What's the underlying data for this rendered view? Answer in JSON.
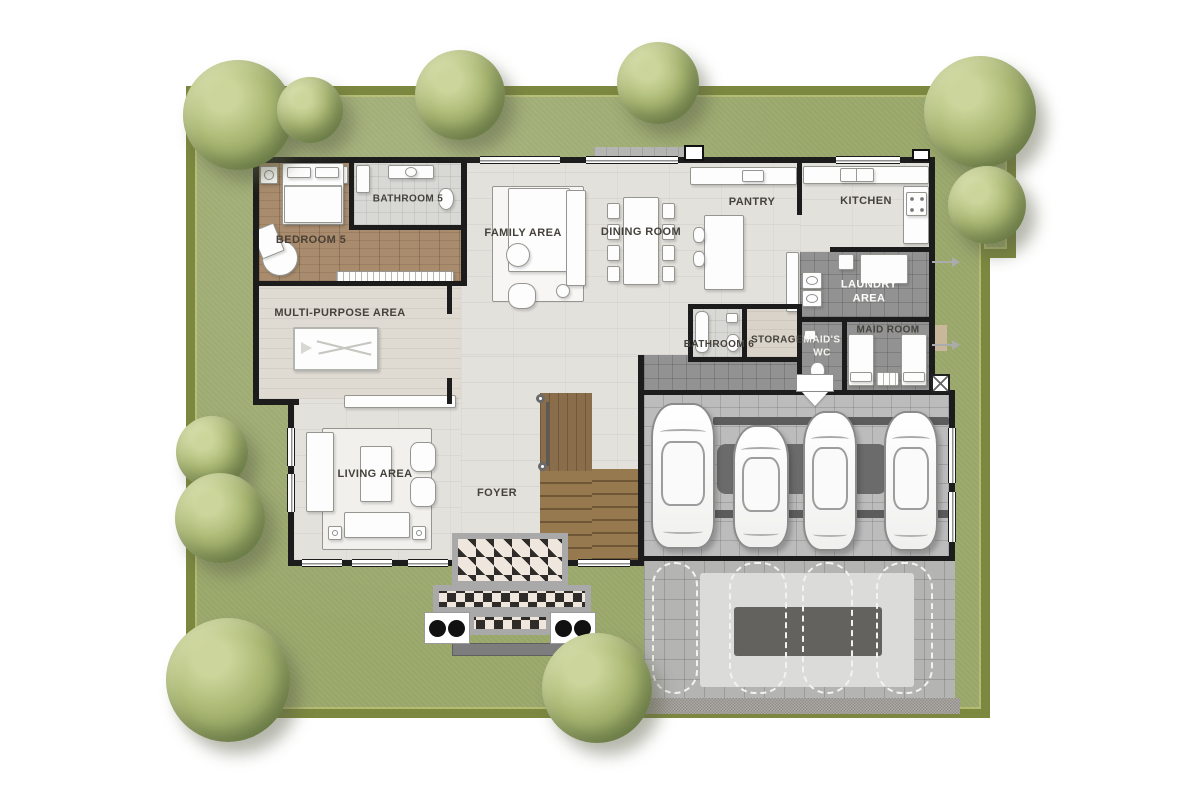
{
  "plan": {
    "type": "residential first-floor plan",
    "rooms": {
      "bedroom5": {
        "label": "BEDROOM 5"
      },
      "bathroom5": {
        "label": "BATHROOM 5"
      },
      "family_area": {
        "label": "FAMILY AREA"
      },
      "dining_room": {
        "label": "DINING ROOM"
      },
      "pantry": {
        "label": "PANTRY"
      },
      "kitchen": {
        "label": "KITCHEN"
      },
      "laundry_area": {
        "label": "LAUNDRY AREA"
      },
      "maid_room": {
        "label": "MAID ROOM"
      },
      "maids_wc": {
        "label": "MAID'S WC"
      },
      "storage": {
        "label": "STORAGE"
      },
      "bathroom6": {
        "label": "BATHROOM 6"
      },
      "multi_purpose_area": {
        "label": "MULTI-PURPOSE AREA"
      },
      "living_area": {
        "label": "LIVING AREA"
      },
      "foyer": {
        "label": "FOYER"
      }
    },
    "garage": {
      "cars_parked": 4,
      "dashed_parking_spaces": 4
    },
    "site": {
      "trees": 10
    },
    "colors": {
      "lawn": "#9dab6f",
      "hedge": "#7c883f",
      "tile_floor": "#e3e1dc",
      "wood_floor": "#a98c6e",
      "dark_tile_floor": "#929292",
      "garage_floor": "#bcbcbc",
      "wall": "#1c1c1c",
      "stair_wood": "#97794f",
      "checker_dark": "#2e2b28",
      "checker_light": "#efe7dd"
    }
  }
}
